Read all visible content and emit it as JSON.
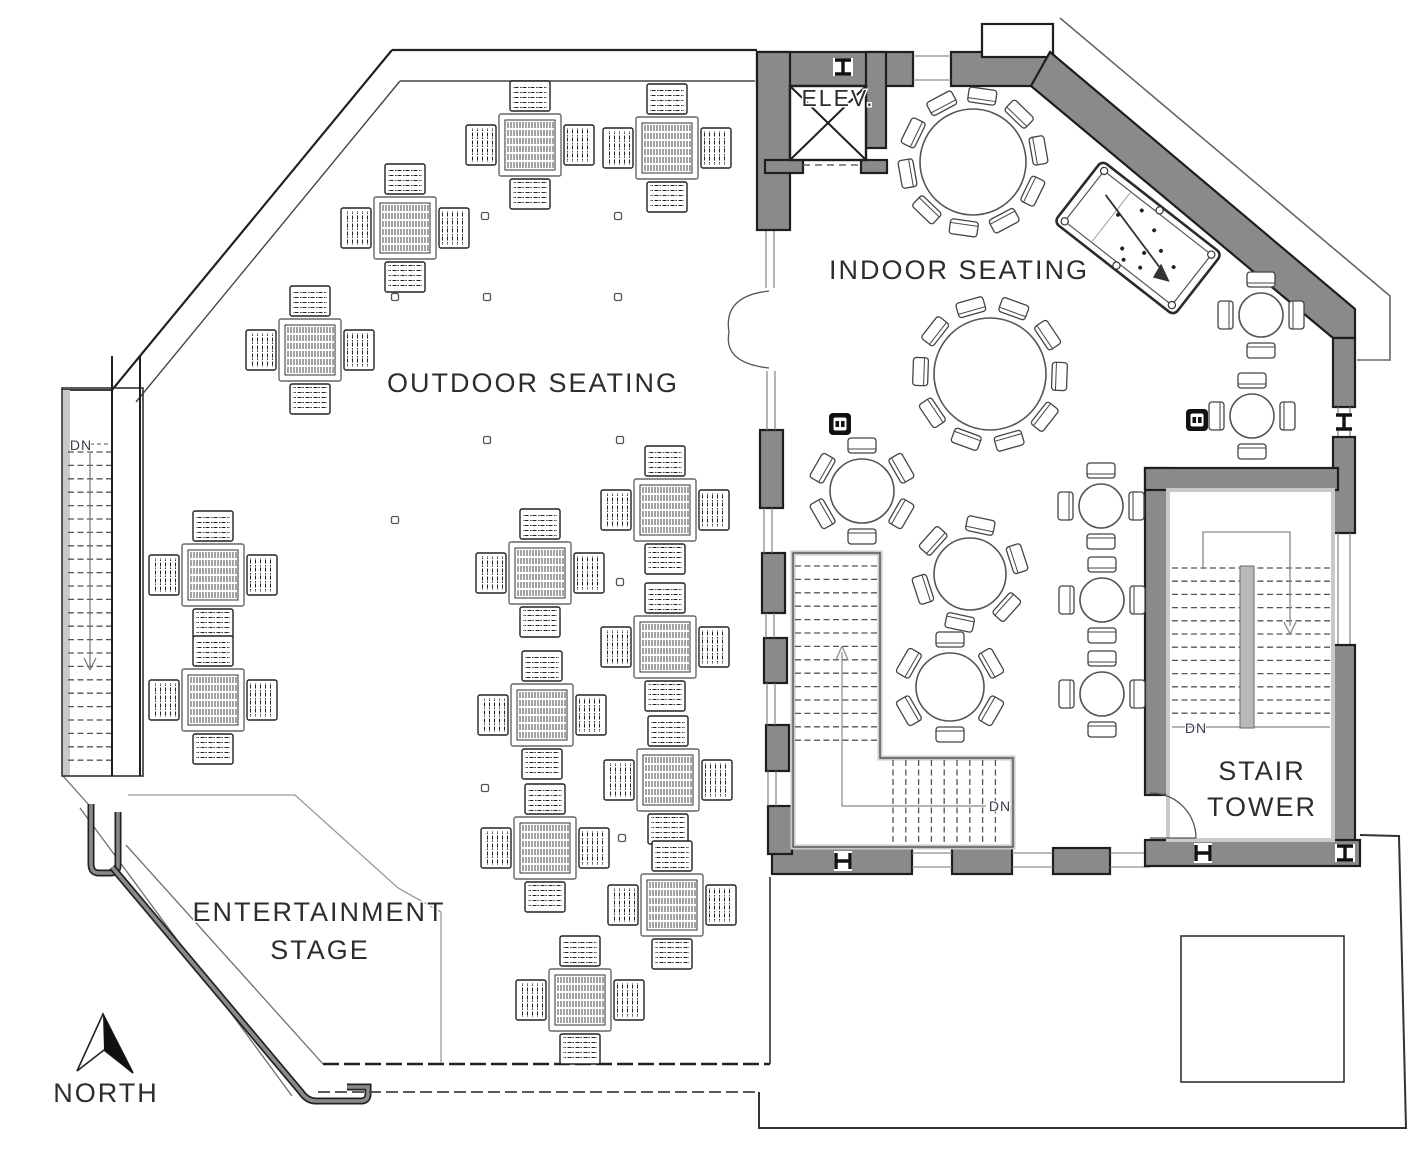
{
  "labels": {
    "outdoor_seating": "OUTDOOR SEATING",
    "indoor_seating": "INDOOR SEATING",
    "elevator": "ELEV.",
    "stair_tower_line1": "STAIR",
    "stair_tower_line2": "TOWER",
    "entertainment_line1": "ENTERTAINMENT",
    "entertainment_line2": "STAGE",
    "north": "NORTH",
    "down": "DN"
  },
  "colors": {
    "wall_gray": "#8a8a8a",
    "light_gray": "#c9c9c9",
    "ink": "#1e1e1e",
    "text": "#2d2d2d"
  },
  "outdoor": {
    "square_tables_4_seats": [
      [
        530,
        145
      ],
      [
        667,
        148
      ],
      [
        405,
        228
      ],
      [
        310,
        350
      ],
      [
        213,
        575
      ],
      [
        213,
        700
      ],
      [
        540,
        573
      ],
      [
        665,
        510
      ],
      [
        665,
        647
      ],
      [
        542,
        715
      ],
      [
        545,
        848
      ],
      [
        668,
        780
      ],
      [
        672,
        905
      ],
      [
        580,
        1000
      ]
    ],
    "deck_dots": [
      [
        485,
        216
      ],
      [
        618,
        216
      ],
      [
        395,
        297
      ],
      [
        487,
        297
      ],
      [
        618,
        297
      ],
      [
        487,
        440
      ],
      [
        620,
        440
      ],
      [
        395,
        520
      ],
      [
        483,
        582
      ],
      [
        620,
        582
      ],
      [
        485,
        788
      ],
      [
        622,
        838
      ]
    ]
  },
  "indoor": {
    "round_tables": [
      {
        "x": 973,
        "y": 162,
        "r": 53,
        "seats": 10,
        "rot": 8
      },
      {
        "x": 990,
        "y": 374,
        "r": 56,
        "seats": 10,
        "rot": 20
      },
      {
        "x": 862,
        "y": 491,
        "r": 32,
        "seats": 6,
        "rot": 0
      },
      {
        "x": 970,
        "y": 574,
        "r": 36,
        "seats": 6,
        "rot": 12
      },
      {
        "x": 950,
        "y": 687,
        "r": 34,
        "seats": 6,
        "rot": 0
      },
      {
        "x": 1101,
        "y": 506,
        "r": 22,
        "seats": 4,
        "rot": 0
      },
      {
        "x": 1102,
        "y": 600,
        "r": 22,
        "seats": 4,
        "rot": 0
      },
      {
        "x": 1102,
        "y": 694,
        "r": 22,
        "seats": 4,
        "rot": 0
      },
      {
        "x": 1261,
        "y": 315,
        "r": 22,
        "seats": 4,
        "rot": 0
      },
      {
        "x": 1252,
        "y": 416,
        "r": 22,
        "seats": 4,
        "rot": 0
      }
    ],
    "column_markers": [
      [
        840,
        424
      ],
      [
        1197,
        420
      ]
    ],
    "steel_columns": [
      {
        "x": 843,
        "y": 67,
        "rot": 0
      },
      {
        "x": 1344,
        "y": 422,
        "rot": 0
      },
      {
        "x": 843,
        "y": 861,
        "rot": 90
      },
      {
        "x": 1203,
        "y": 853,
        "rot": 90
      },
      {
        "x": 1345,
        "y": 853,
        "rot": 0
      }
    ],
    "pool_table": {
      "x": 1138,
      "y": 238,
      "rotation": 38
    }
  }
}
